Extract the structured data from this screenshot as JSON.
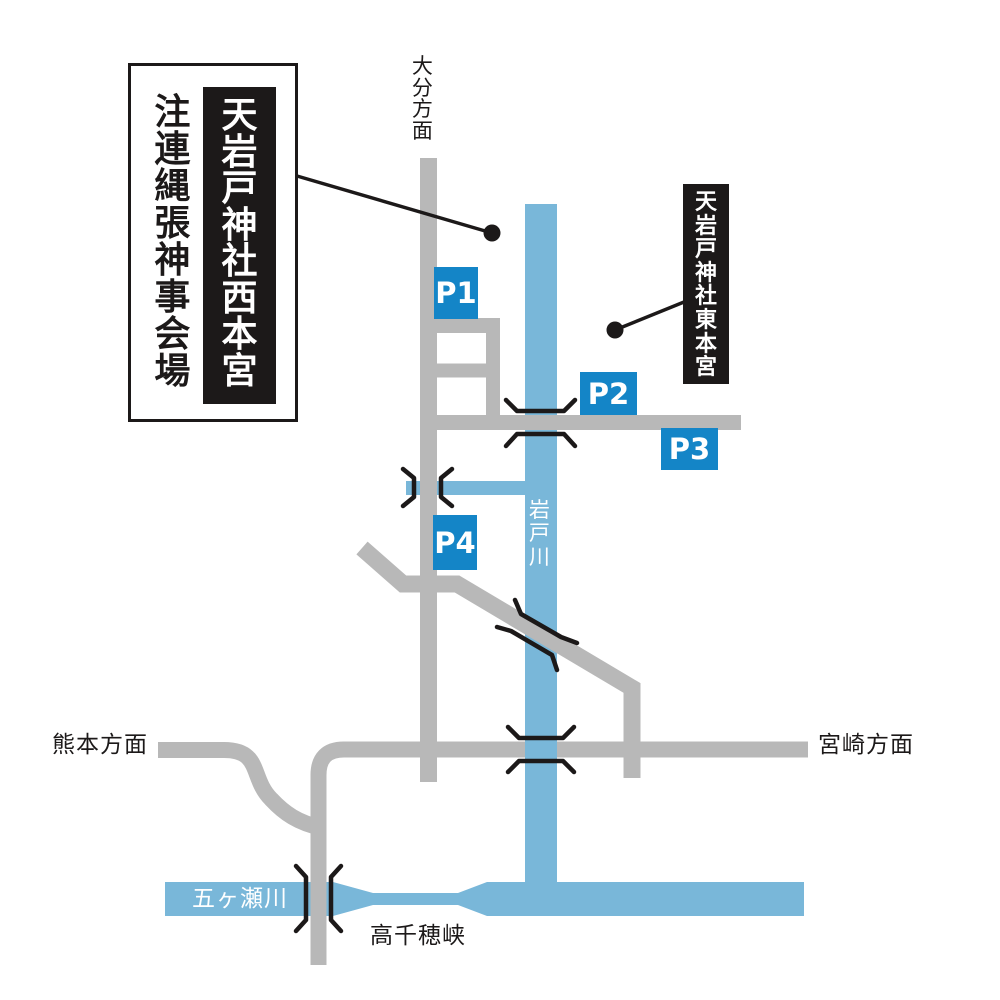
{
  "map": {
    "venue_box": {
      "event": "注連縄張神事会場",
      "shrine": "天岩戸神社西本宮"
    },
    "east_shrine": "天岩戸神社東本宮",
    "directions": {
      "oita": "大分方面",
      "kumamoto": "熊本方面",
      "miyazaki": "宮崎方面"
    },
    "rivers": {
      "iwato": "岩戸川",
      "gokase": "五ヶ瀬川"
    },
    "gorge": "高千穂峡",
    "parking": [
      {
        "id": "P1"
      },
      {
        "id": "P2"
      },
      {
        "id": "P3"
      },
      {
        "id": "P4"
      }
    ],
    "colors": {
      "road": "#b8b8b8",
      "river": "#79b7d9",
      "parking": "#1485c7",
      "ink": "#1c1919"
    }
  }
}
